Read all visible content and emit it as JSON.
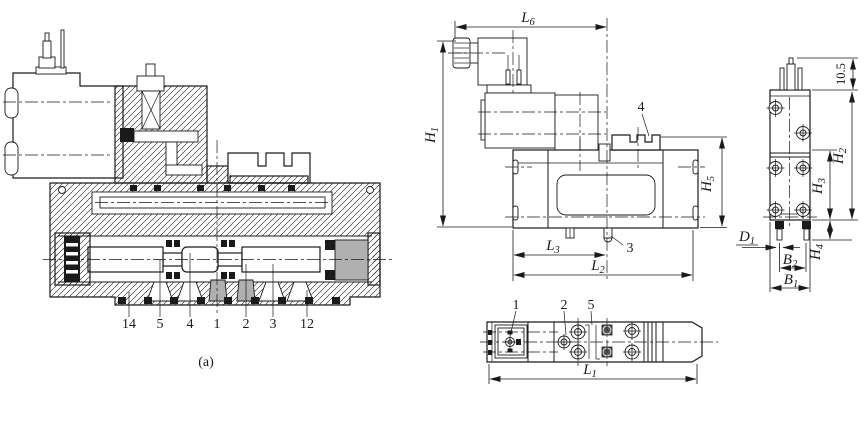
{
  "colors": {
    "line": "#1a1a1a",
    "gray_fill": "#b0b0b0",
    "dark_fill": "#555555",
    "background": "#ffffff"
  },
  "section_view": {
    "caption": "(a)",
    "port_labels": [
      "14",
      "5",
      "4",
      "1",
      "2",
      "3",
      "12"
    ]
  },
  "front_view": {
    "part_top": "4",
    "part_bottom": "3",
    "dims": {
      "L6": {
        "base": "L",
        "sub": "6"
      },
      "H1": {
        "base": "H",
        "sub": "1"
      },
      "H5": {
        "base": "H",
        "sub": "5"
      },
      "L3": {
        "base": "L",
        "sub": "3"
      },
      "L2": {
        "base": "L",
        "sub": "2"
      }
    }
  },
  "side_view": {
    "dims": {
      "offset": "10.5",
      "H2": {
        "base": "H",
        "sub": "2"
      },
      "H3": {
        "base": "H",
        "sub": "3"
      },
      "H4": {
        "base": "H",
        "sub": "4"
      },
      "D1": {
        "base": "D",
        "sub": "1"
      },
      "B2": {
        "base": "B",
        "sub": "2"
      },
      "B1": {
        "base": "B",
        "sub": "1"
      }
    }
  },
  "top_view": {
    "part_labels": [
      "1",
      "2",
      "5"
    ],
    "dims": {
      "L1": {
        "base": "L",
        "sub": "1"
      }
    }
  }
}
